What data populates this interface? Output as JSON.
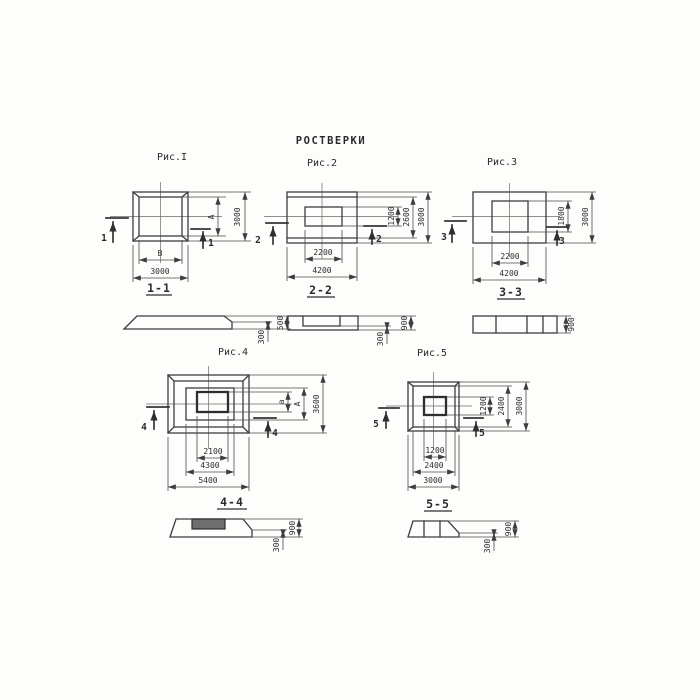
{
  "title": "РОСТВЕРКИ",
  "figures": [
    {
      "label": "Рис.I",
      "plan": {
        "dims_bottom": [
          "В",
          "3000"
        ],
        "dims_right": [
          "А",
          "3000"
        ],
        "cut_mark": "1"
      },
      "section": {
        "label": "1-1",
        "dims": [
          "500",
          "300"
        ]
      }
    },
    {
      "label": "Рис.2",
      "plan": {
        "dims_bottom": [
          "2200",
          "4200"
        ],
        "dims_right": [
          "1200",
          "2600",
          "3000"
        ],
        "cut_mark": "2"
      },
      "section": {
        "label": "2-2",
        "dims": [
          "900",
          "300"
        ]
      }
    },
    {
      "label": "Рис.3",
      "plan": {
        "dims_bottom": [
          "2200",
          "4200"
        ],
        "dims_right": [
          "1800",
          "3000"
        ],
        "cut_mark": "3"
      },
      "section": {
        "label": "3-3",
        "dims": [
          "900"
        ]
      }
    },
    {
      "label": "Рис.4",
      "plan": {
        "dims_bottom": [
          "2100",
          "4300",
          "5400"
        ],
        "dims_right": [
          "а",
          "А",
          "3600"
        ],
        "cut_mark": "4"
      },
      "section": {
        "label": "4-4",
        "dims": [
          "900",
          "300"
        ]
      }
    },
    {
      "label": "Рис.5",
      "plan": {
        "dims_bottom": [
          "1200",
          "2400",
          "3000"
        ],
        "dims_right": [
          "1200",
          "2400",
          "3000"
        ],
        "cut_mark": "5"
      },
      "section": {
        "label": "5-5",
        "dims": [
          "900",
          "300"
        ]
      }
    }
  ]
}
